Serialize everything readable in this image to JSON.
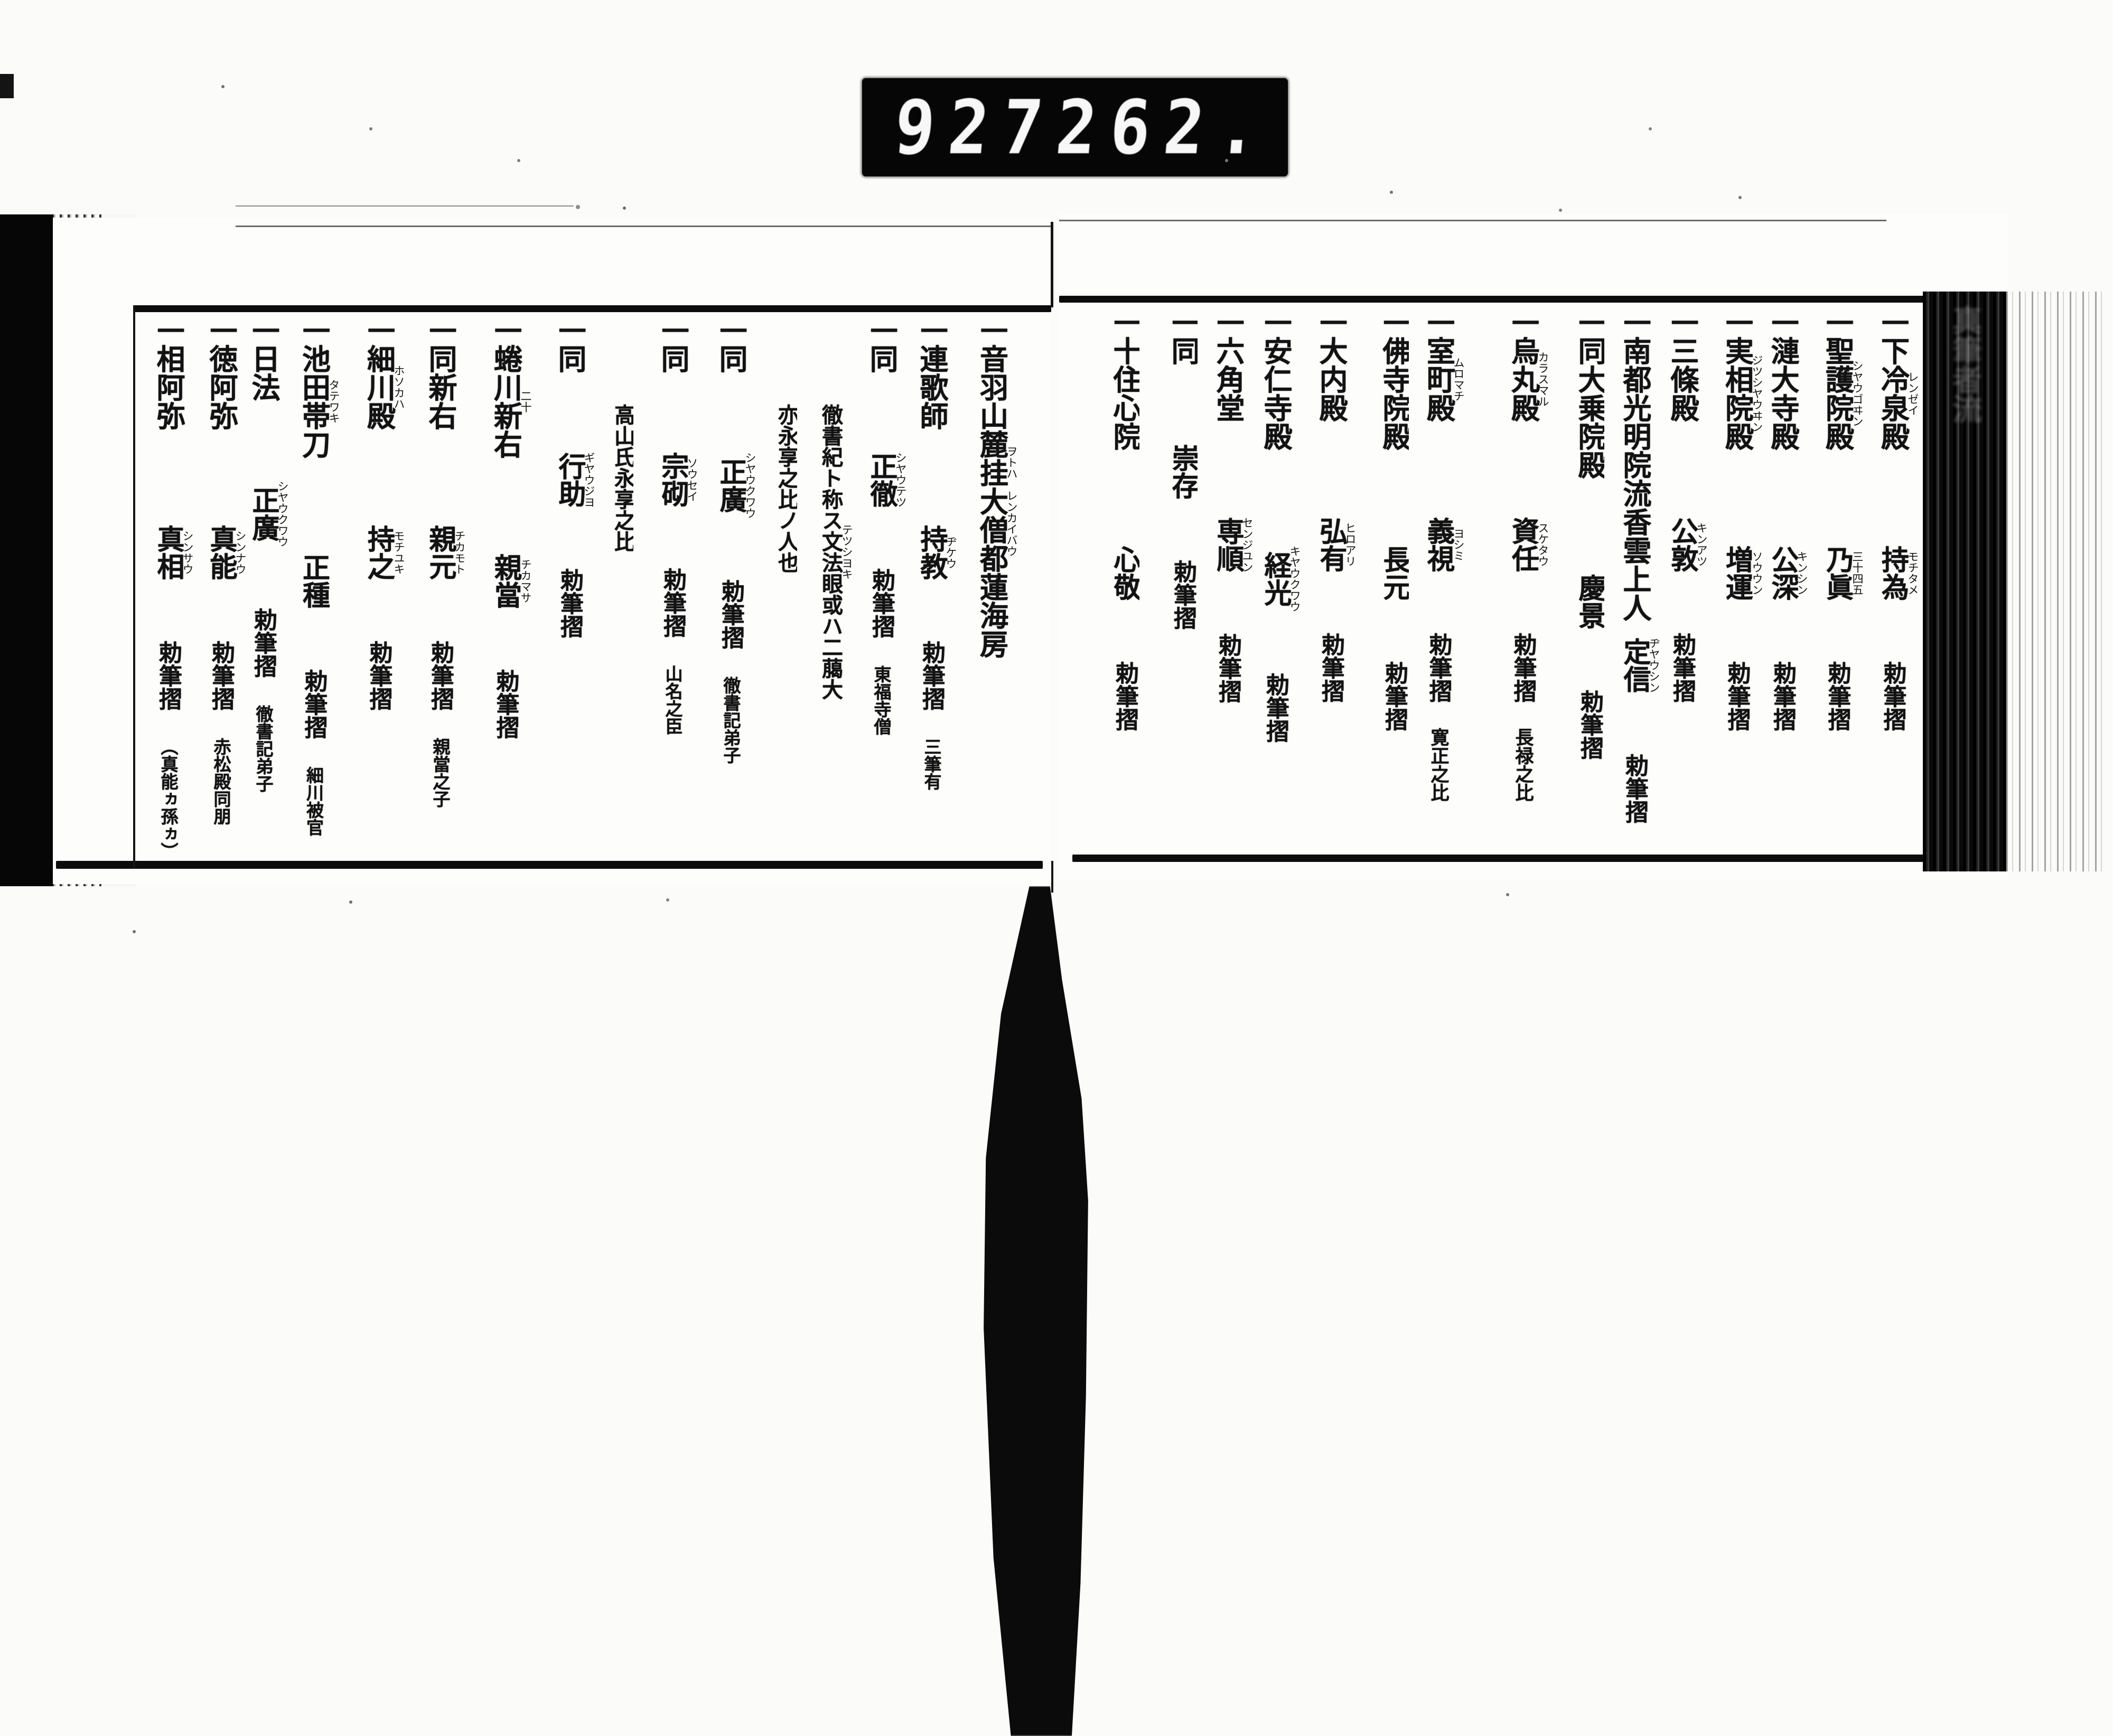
{
  "counter": {
    "left_digits": "927",
    "right_digits": "262."
  },
  "item_marker": "一",
  "choku_label": "勅筆摺",
  "spine": {
    "circle": "〇",
    "title": "真筆者流",
    "volume": "全",
    "number": "十"
  },
  "right_page": {
    "columns": [
      {
        "title": "同勾當内侍"
      },
      {
        "title": "下冷泉殿",
        "title_rt": "レンゼイ",
        "name": "持為",
        "name_rt": "モチタメ",
        "choku": "勅筆摺"
      },
      {
        "title": "聖護院殿",
        "title_rt": "シヤウゴヰン",
        "name": "乃眞",
        "name_rt": "三十四五",
        "choku": "勅筆摺"
      },
      {
        "title": "漣大寺殿",
        "name": "公深",
        "name_rt": "キンシン",
        "choku": "勅筆摺"
      },
      {
        "title": "実相院殿",
        "title_rt": "ジツシヤウヰン",
        "name": "増運",
        "name_rt": "ソウウン",
        "choku": "勅筆摺"
      },
      {
        "title": "三條殿",
        "name": "公敦",
        "name_rt": "キンアツ",
        "choku": "勅筆摺"
      },
      {
        "title": "南都光明院流香雲上人",
        "name": "定信",
        "name_rt": "ヂヤウシン",
        "choku": "勅筆摺"
      },
      {
        "title": "同大乗院殿",
        "name": "慶景",
        "choku": "勅筆摺"
      },
      {
        "title": "烏丸殿",
        "title_rt": "カラスマル",
        "name": "資任",
        "name_rt": "スケタウ",
        "choku": "勅筆摺",
        "era": "長禄之比"
      },
      {
        "title": "室町殿",
        "title_rt": "ムロマチ",
        "name": "義視",
        "name_rt": "ヨシミ",
        "choku": "勅筆摺",
        "era": "寛正之比"
      },
      {
        "title": "佛寺院殿",
        "name": "長元",
        "choku": "勅筆摺"
      },
      {
        "title": "大内殿",
        "name": "弘有",
        "name_rt": "ヒロアリ",
        "choku": "勅筆摺"
      },
      {
        "title": "安仁寺殿",
        "name": "経光",
        "name_rt": "キヤウクワウ",
        "choku": "勅筆摺"
      },
      {
        "title": "六角堂",
        "name": "専順",
        "name_rt": "センジユン",
        "choku": "勅筆摺"
      },
      {
        "title": "同",
        "name": "崇存",
        "choku": "勅筆摺"
      },
      {
        "title": "十住心院",
        "name": "心敬",
        "choku": "勅筆摺"
      }
    ]
  },
  "left_page": {
    "columns": [
      {
        "title": "音羽山麓挂大僧都蓮海房",
        "title_rt": "ヲトハ　レンカイバウ"
      },
      {
        "title": "連歌師",
        "name": "持教",
        "name_rt": "ヂケウ",
        "choku": "勅筆摺",
        "note": "三筆有"
      },
      {
        "title": "同",
        "name": "正徹",
        "name_rt": "シヤウテツ",
        "choku": "勅筆摺",
        "note": "東福寺僧"
      },
      {
        "annotation": "徹書紀ト称ス文法眼或ハ二﨟大",
        "annotation_rt": "テツシヨキ"
      },
      {
        "annotation": "亦永享之比ノ人也"
      },
      {
        "title": "同",
        "name": "正廣",
        "name_rt": "シヤウクワウ",
        "choku": "勅筆摺",
        "note": "徹書記弟子"
      },
      {
        "title": "同",
        "name": "宗砌",
        "name_rt": "ソウセイ",
        "choku": "勅筆摺",
        "note": "山名之臣"
      },
      {
        "annotation": "高山氏永享之比"
      },
      {
        "title": "同",
        "name": "行助",
        "name_rt": "ギヤウジヨ",
        "choku": "勅筆摺"
      },
      {
        "title": "蜷川新右",
        "title_rt": "二十",
        "name": "親當",
        "name_rt": "チカマサ",
        "choku": "勅筆摺"
      },
      {
        "title": "同新右",
        "name": "親元",
        "name_rt": "チカモト",
        "choku": "勅筆摺",
        "note": "親當之子"
      },
      {
        "title": "細川殿",
        "title_rt": "ホソカハ",
        "name": "持之",
        "name_rt": "モチユキ",
        "choku": "勅筆摺"
      },
      {
        "title": "池田帯刀",
        "title_rt": "タテワキ",
        "name": "正種",
        "choku": "勅筆摺",
        "note": "細川被官"
      },
      {
        "title": "日法",
        "name": "正廣",
        "name_rt": "シヤウクワウ",
        "choku": "勅筆摺",
        "note": "徹書記弟子"
      },
      {
        "title": "徳阿弥",
        "name": "真能",
        "name_rt": "シンナウ",
        "choku": "勅筆摺",
        "note": "赤松殿同朋"
      },
      {
        "title": "相阿弥",
        "name": "真相",
        "name_rt": "シンサウ",
        "choku": "勅筆摺",
        "note": "（真能ヵ孫ヵ）"
      }
    ]
  }
}
